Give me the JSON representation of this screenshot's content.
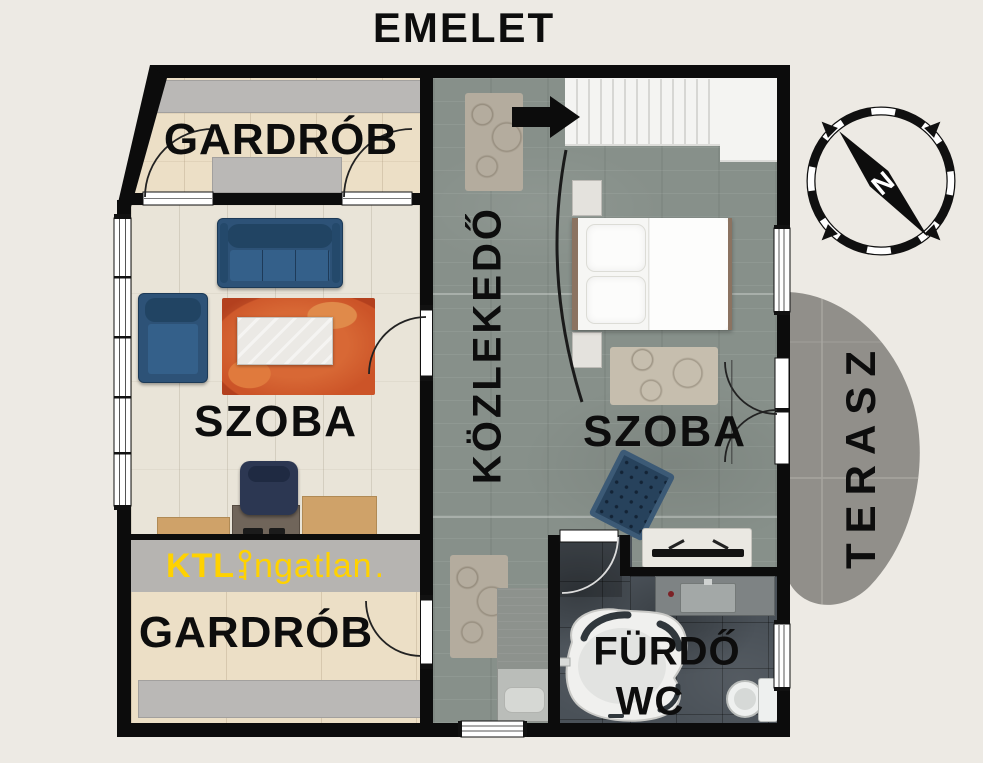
{
  "title": "EMELET",
  "rooms": {
    "wardrobe_top": {
      "label": "GARDRÓB"
    },
    "living_room": {
      "label": "SZOBA"
    },
    "hallway": {
      "label": "KÖZLEKEDŐ"
    },
    "bedroom": {
      "label": "SZOBA"
    },
    "wardrobe_bottom": {
      "label": "GARDRÓB"
    },
    "bathroom": {
      "label": "FÜRDŐ"
    },
    "wc": {
      "label": "WC"
    },
    "terrace": {
      "label": "TERASZ"
    }
  },
  "logo": {
    "brand_bold": "KTL",
    "brand_rest": "ngatlan",
    "period": ".",
    "color": "#FFD200"
  },
  "compass": {
    "north_label": "N"
  },
  "icons": {
    "entry_arrow": "black-right-arrow",
    "compass": "compass-rose-needle-northwest",
    "logo_key": "gold-key-as-letter-i"
  },
  "colors": {
    "background": "#EDEAE4",
    "wall": "#0C0C0C",
    "wardrobe_floor": "#ECDFC6",
    "living_floor": "#E9E4D8",
    "hall_floor": "#87908A",
    "bathroom_floor": "#4A5158",
    "terrace": "#918F8A",
    "closet_gray": "#BAB8B6",
    "sofa_blue": "#2D5277",
    "rug_orange": "#C74F26",
    "logo_gold": "#FFD200"
  }
}
